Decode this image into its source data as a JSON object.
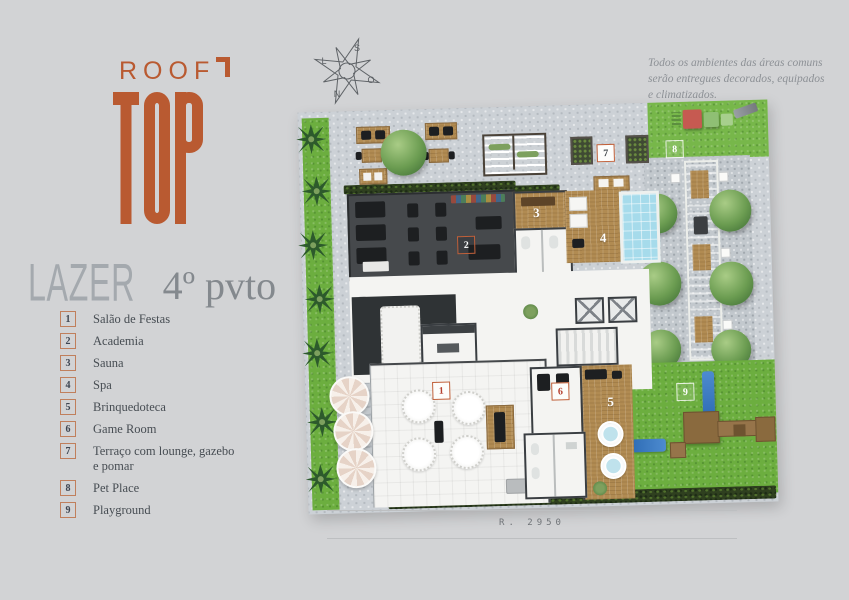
{
  "logo": {
    "line1": "ROOF",
    "line2": "TOP",
    "accent_color": "#b95a31"
  },
  "compass": {
    "top": "S",
    "bottom": "N",
    "left": "L",
    "right": "O"
  },
  "disclaimer": {
    "line1": "Todos os ambientes das áreas comuns",
    "line2": "serão entregues decorados, equipados",
    "line3": "e climatizados."
  },
  "subtitle": {
    "word": "LAZER",
    "floor": "4º pvto"
  },
  "legend": {
    "items": [
      {
        "number": "1",
        "label": "Salão de Festas"
      },
      {
        "number": "2",
        "label": "Academia"
      },
      {
        "number": "3",
        "label": "Sauna"
      },
      {
        "number": "4",
        "label": "Spa"
      },
      {
        "number": "5",
        "label": "Brinquedoteca"
      },
      {
        "number": "6",
        "label": "Game Room"
      },
      {
        "number": "7",
        "label": "Terraço com lounge, gazebo e pomar"
      },
      {
        "number": "8",
        "label": "Pet Place"
      },
      {
        "number": "9",
        "label": "Playground"
      }
    ]
  },
  "plan": {
    "markers": [
      {
        "number": "1"
      },
      {
        "number": "2"
      },
      {
        "number": "3"
      },
      {
        "number": "4"
      },
      {
        "number": "5"
      },
      {
        "number": "6"
      },
      {
        "number": "7"
      },
      {
        "number": "8"
      },
      {
        "number": "9"
      }
    ]
  },
  "footer": {
    "reference": "R. 2950"
  },
  "colors": {
    "background": "#d2d3d5",
    "accent": "#b95a31",
    "legend_border": "#c07f5c",
    "grass": "#6cae3f",
    "pool": "#a6dbeb",
    "gym_floor": "#46494c",
    "wood_deck": "#b18b52"
  }
}
